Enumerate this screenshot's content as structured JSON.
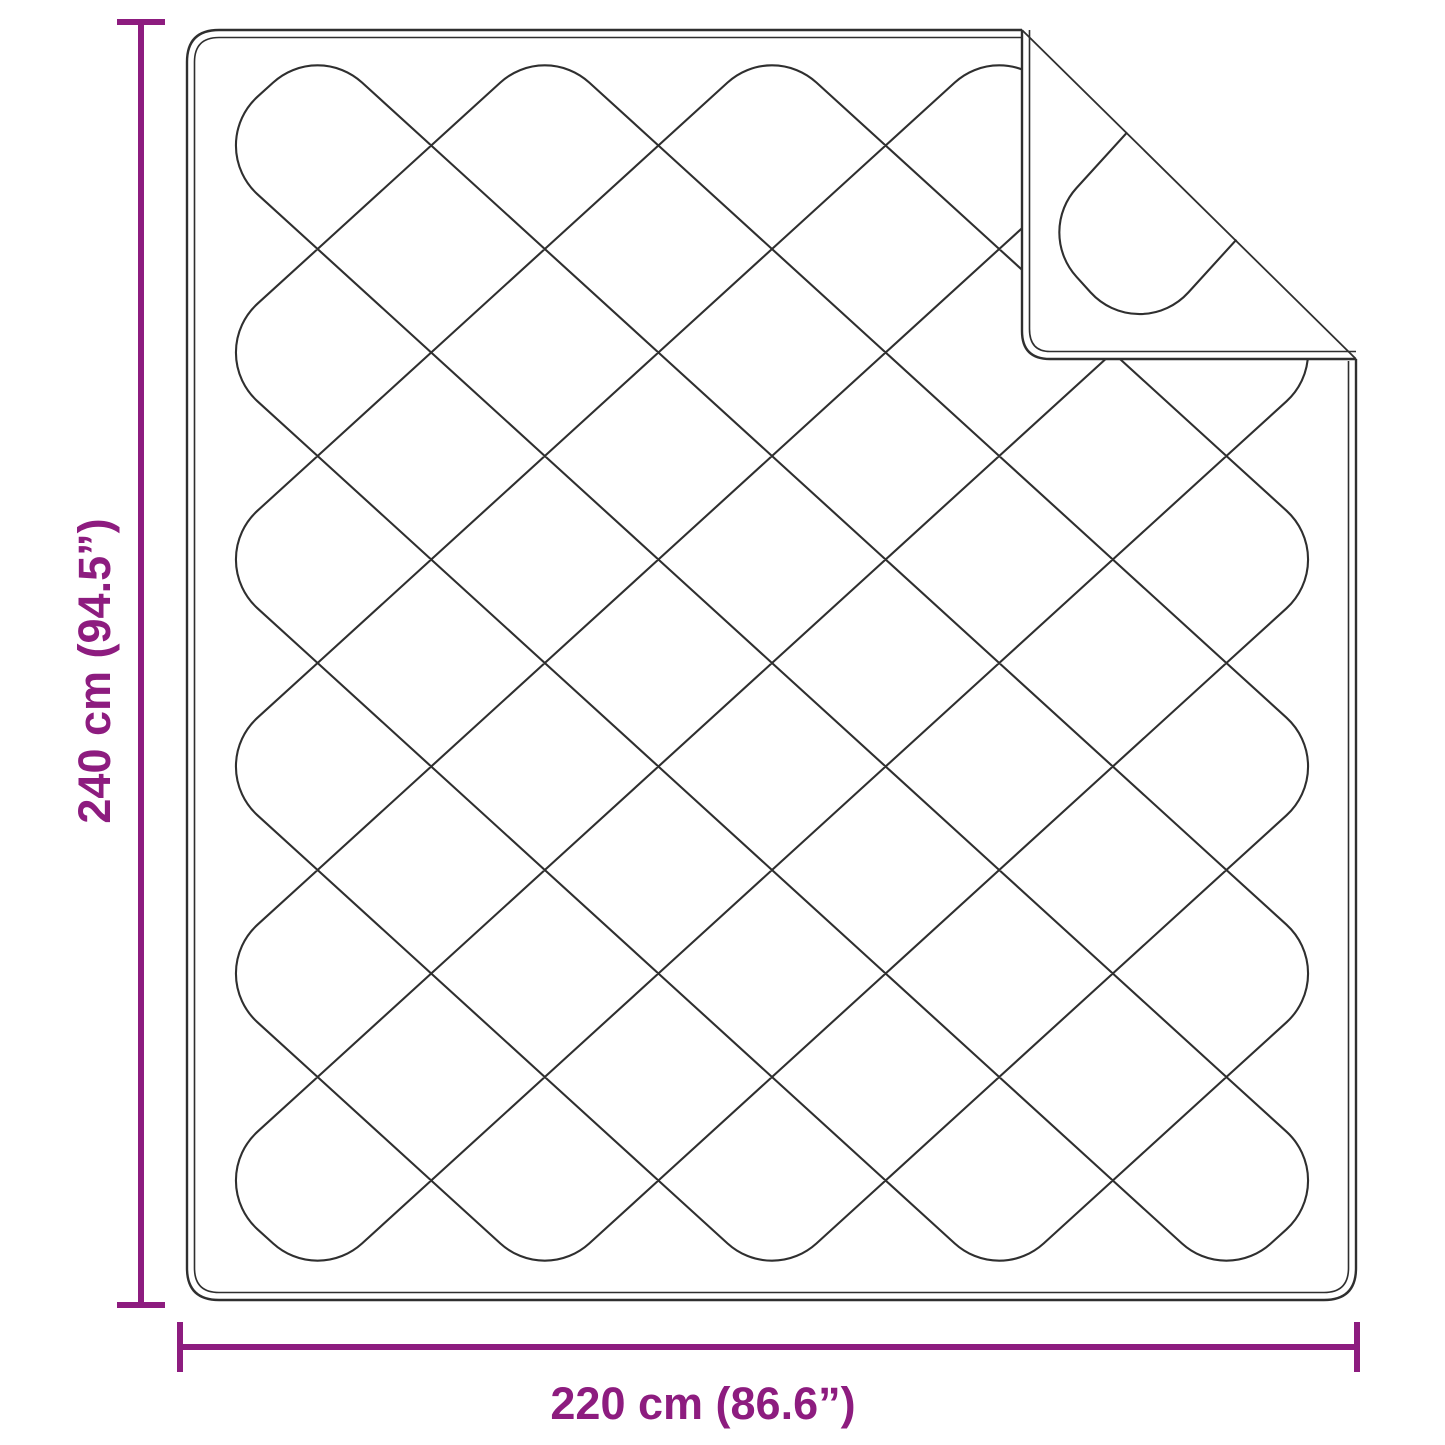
{
  "dimensions": {
    "height_label": "240 cm (94.5”)",
    "width_label": "220 cm (86.6”)"
  },
  "colors": {
    "dimension": "#8d1c7f",
    "line": "#2f2f2f",
    "background": "#ffffff"
  },
  "diagram": {
    "canvas": {
      "w": 1445,
      "h": 1445
    },
    "outline": {
      "left": 187,
      "top": 30,
      "right": 1356,
      "bottom": 1300,
      "corner_radius": 32,
      "piping_inset": 7.5
    },
    "fold": {
      "edge_x": 1022,
      "edge_y": 359,
      "corner_radius": 28,
      "crease_x2": 1356,
      "crease_y2": 359,
      "mirror_c": 994
    },
    "lattice": {
      "x0": 204,
      "y0": 42,
      "cols": 10,
      "rows": 12,
      "w": 113.6,
      "h": 103.5,
      "cap_radius": 66
    },
    "strokes": {
      "pattern": 2.1,
      "outline": 2.4,
      "piping": 1.6,
      "crease": 1.8,
      "dimension": 6
    },
    "dim_v": {
      "x": 141,
      "y1": 22,
      "y2": 1305,
      "cap_half": 24
    },
    "dim_h": {
      "y": 1347,
      "x1": 180,
      "x2": 1357,
      "cap_half": 25
    }
  }
}
